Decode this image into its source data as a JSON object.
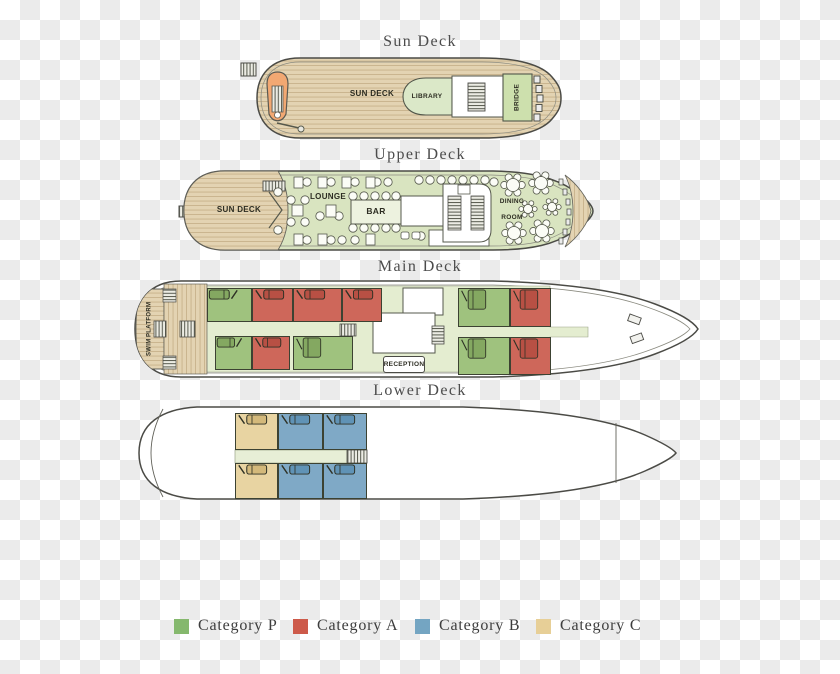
{
  "decks": {
    "sun": {
      "title": "Sun Deck",
      "deck_label": "SUN DECK",
      "library": "LIBRARY",
      "bridge": "BRIDGE"
    },
    "upper": {
      "title": "Upper Deck",
      "deck_label": "SUN DECK",
      "lounge": "LOUNGE",
      "bar": "BAR",
      "dining1": "DINING",
      "dining2": "ROOM"
    },
    "main": {
      "title": "Main Deck",
      "swim1": "SWIM",
      "swim2": "PLATFORM",
      "reception": "RECEPTION"
    },
    "lower": {
      "title": "Lower Deck"
    }
  },
  "legend": {
    "items": [
      {
        "label": "Category P",
        "color": "#85b86d"
      },
      {
        "label": "Category A",
        "color": "#cd5a4a"
      },
      {
        "label": "Category B",
        "color": "#74a5c2"
      },
      {
        "label": "Category C",
        "color": "#e7cf97"
      }
    ]
  },
  "cabins": {
    "categories": {
      "P": {
        "room": "#9fc27e",
        "bed": "#84a861"
      },
      "A": {
        "room": "#ce675a",
        "bed": "#b85044"
      },
      "B": {
        "room": "#7fa9c6",
        "bed": "#6093b6"
      },
      "C": {
        "room": "#e8d4a2",
        "bed": "#d3b97b"
      }
    },
    "main": [
      {
        "x": 74,
        "y": 8,
        "w": 45,
        "h": 34,
        "cat": "P",
        "beds": "2s",
        "flip": true
      },
      {
        "x": 119,
        "y": 8,
        "w": 41,
        "h": 34,
        "cat": "A",
        "beds": "2s"
      },
      {
        "x": 160,
        "y": 8,
        "w": 49,
        "h": 34,
        "cat": "A",
        "beds": "2s"
      },
      {
        "x": 209,
        "y": 8,
        "w": 40,
        "h": 34,
        "cat": "A",
        "beds": "2s"
      },
      {
        "x": 325,
        "y": 8,
        "w": 52,
        "h": 39,
        "cat": "P",
        "beds": "1d"
      },
      {
        "x": 377,
        "y": 8,
        "w": 41,
        "h": 39,
        "cat": "A",
        "beds": "1d"
      },
      {
        "x": 82,
        "y": 56,
        "w": 37,
        "h": 34,
        "cat": "P",
        "beds": "2s",
        "flip": true
      },
      {
        "x": 119,
        "y": 56,
        "w": 38,
        "h": 34,
        "cat": "A",
        "beds": "2s"
      },
      {
        "x": 160,
        "y": 56,
        "w": 60,
        "h": 34,
        "cat": "P",
        "beds": "1d"
      },
      {
        "x": 325,
        "y": 57,
        "w": 52,
        "h": 38,
        "cat": "P",
        "beds": "1d"
      },
      {
        "x": 377,
        "y": 57,
        "w": 41,
        "h": 38,
        "cat": "A",
        "beds": "1d"
      }
    ],
    "lower": [
      {
        "x": 102,
        "y": 9,
        "w": 43,
        "h": 37,
        "cat": "C",
        "beds": "2s"
      },
      {
        "x": 145,
        "y": 9,
        "w": 45,
        "h": 37,
        "cat": "B",
        "beds": "2s"
      },
      {
        "x": 190,
        "y": 9,
        "w": 44,
        "h": 37,
        "cat": "B",
        "beds": "2s"
      },
      {
        "x": 102,
        "y": 59,
        "w": 43,
        "h": 36,
        "cat": "C",
        "beds": "2s"
      },
      {
        "x": 145,
        "y": 59,
        "w": 45,
        "h": 36,
        "cat": "B",
        "beds": "2s"
      },
      {
        "x": 190,
        "y": 59,
        "w": 44,
        "h": 36,
        "cat": "B",
        "beds": "2s"
      }
    ]
  }
}
